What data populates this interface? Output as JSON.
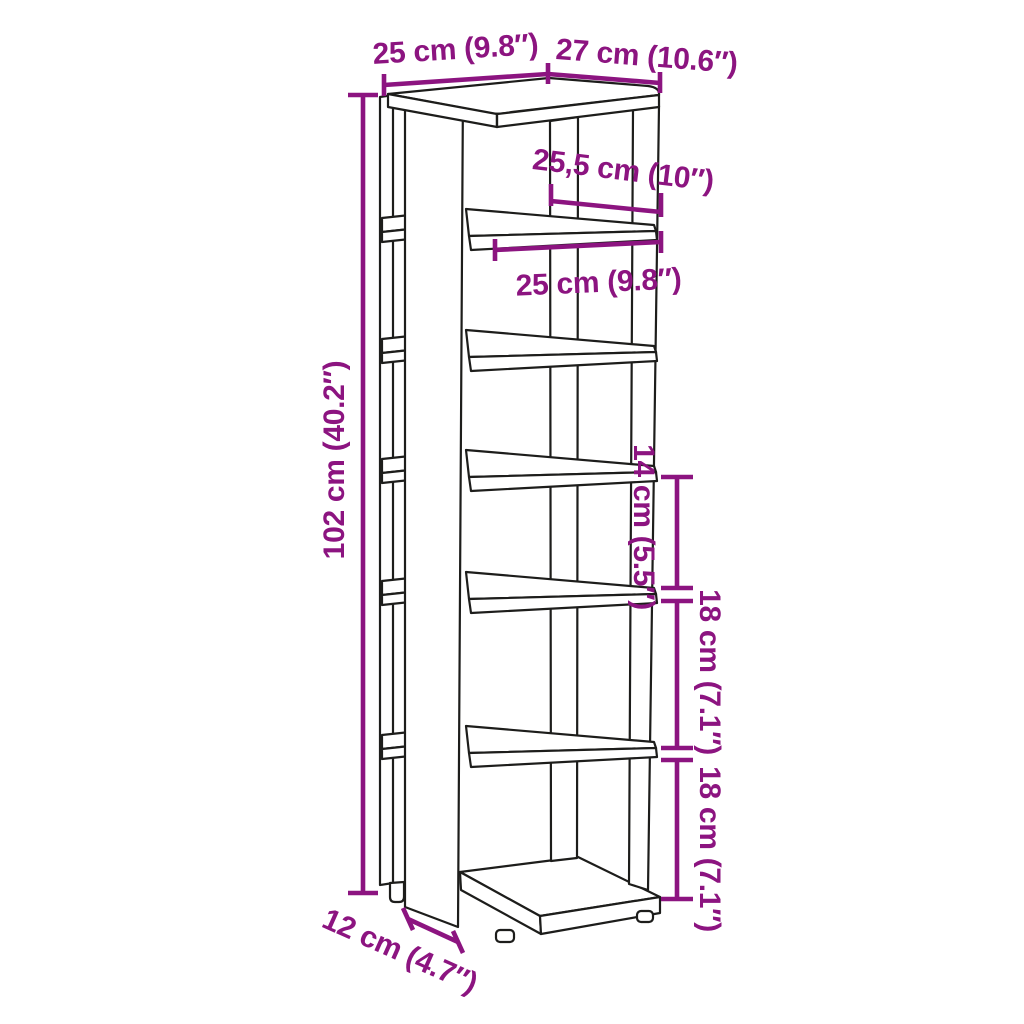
{
  "diagram": {
    "background_color": "#ffffff",
    "artwork_line_color": "#1d1d1b",
    "dimension_color": "#8C1480",
    "shelf_count": 7,
    "dimensions": [
      {
        "id": "top-width",
        "label": "25 cm (9.8″)"
      },
      {
        "id": "top-depth",
        "label": "27 cm (10.6″)"
      },
      {
        "id": "shelf-clearance",
        "label": "25,5 cm (10″)"
      },
      {
        "id": "shelf-width",
        "label": "25 cm (9.8″)"
      },
      {
        "id": "total-height",
        "label": "102 cm (40.2″)"
      },
      {
        "id": "gap-middle",
        "label": "14 cm (5.5″)"
      },
      {
        "id": "gap-lower",
        "label": "18 cm (7.1″)"
      },
      {
        "id": "gap-bottom",
        "label": "18 cm (7.1″)"
      },
      {
        "id": "base-depth",
        "label": "12 cm (4.7″)"
      }
    ]
  }
}
